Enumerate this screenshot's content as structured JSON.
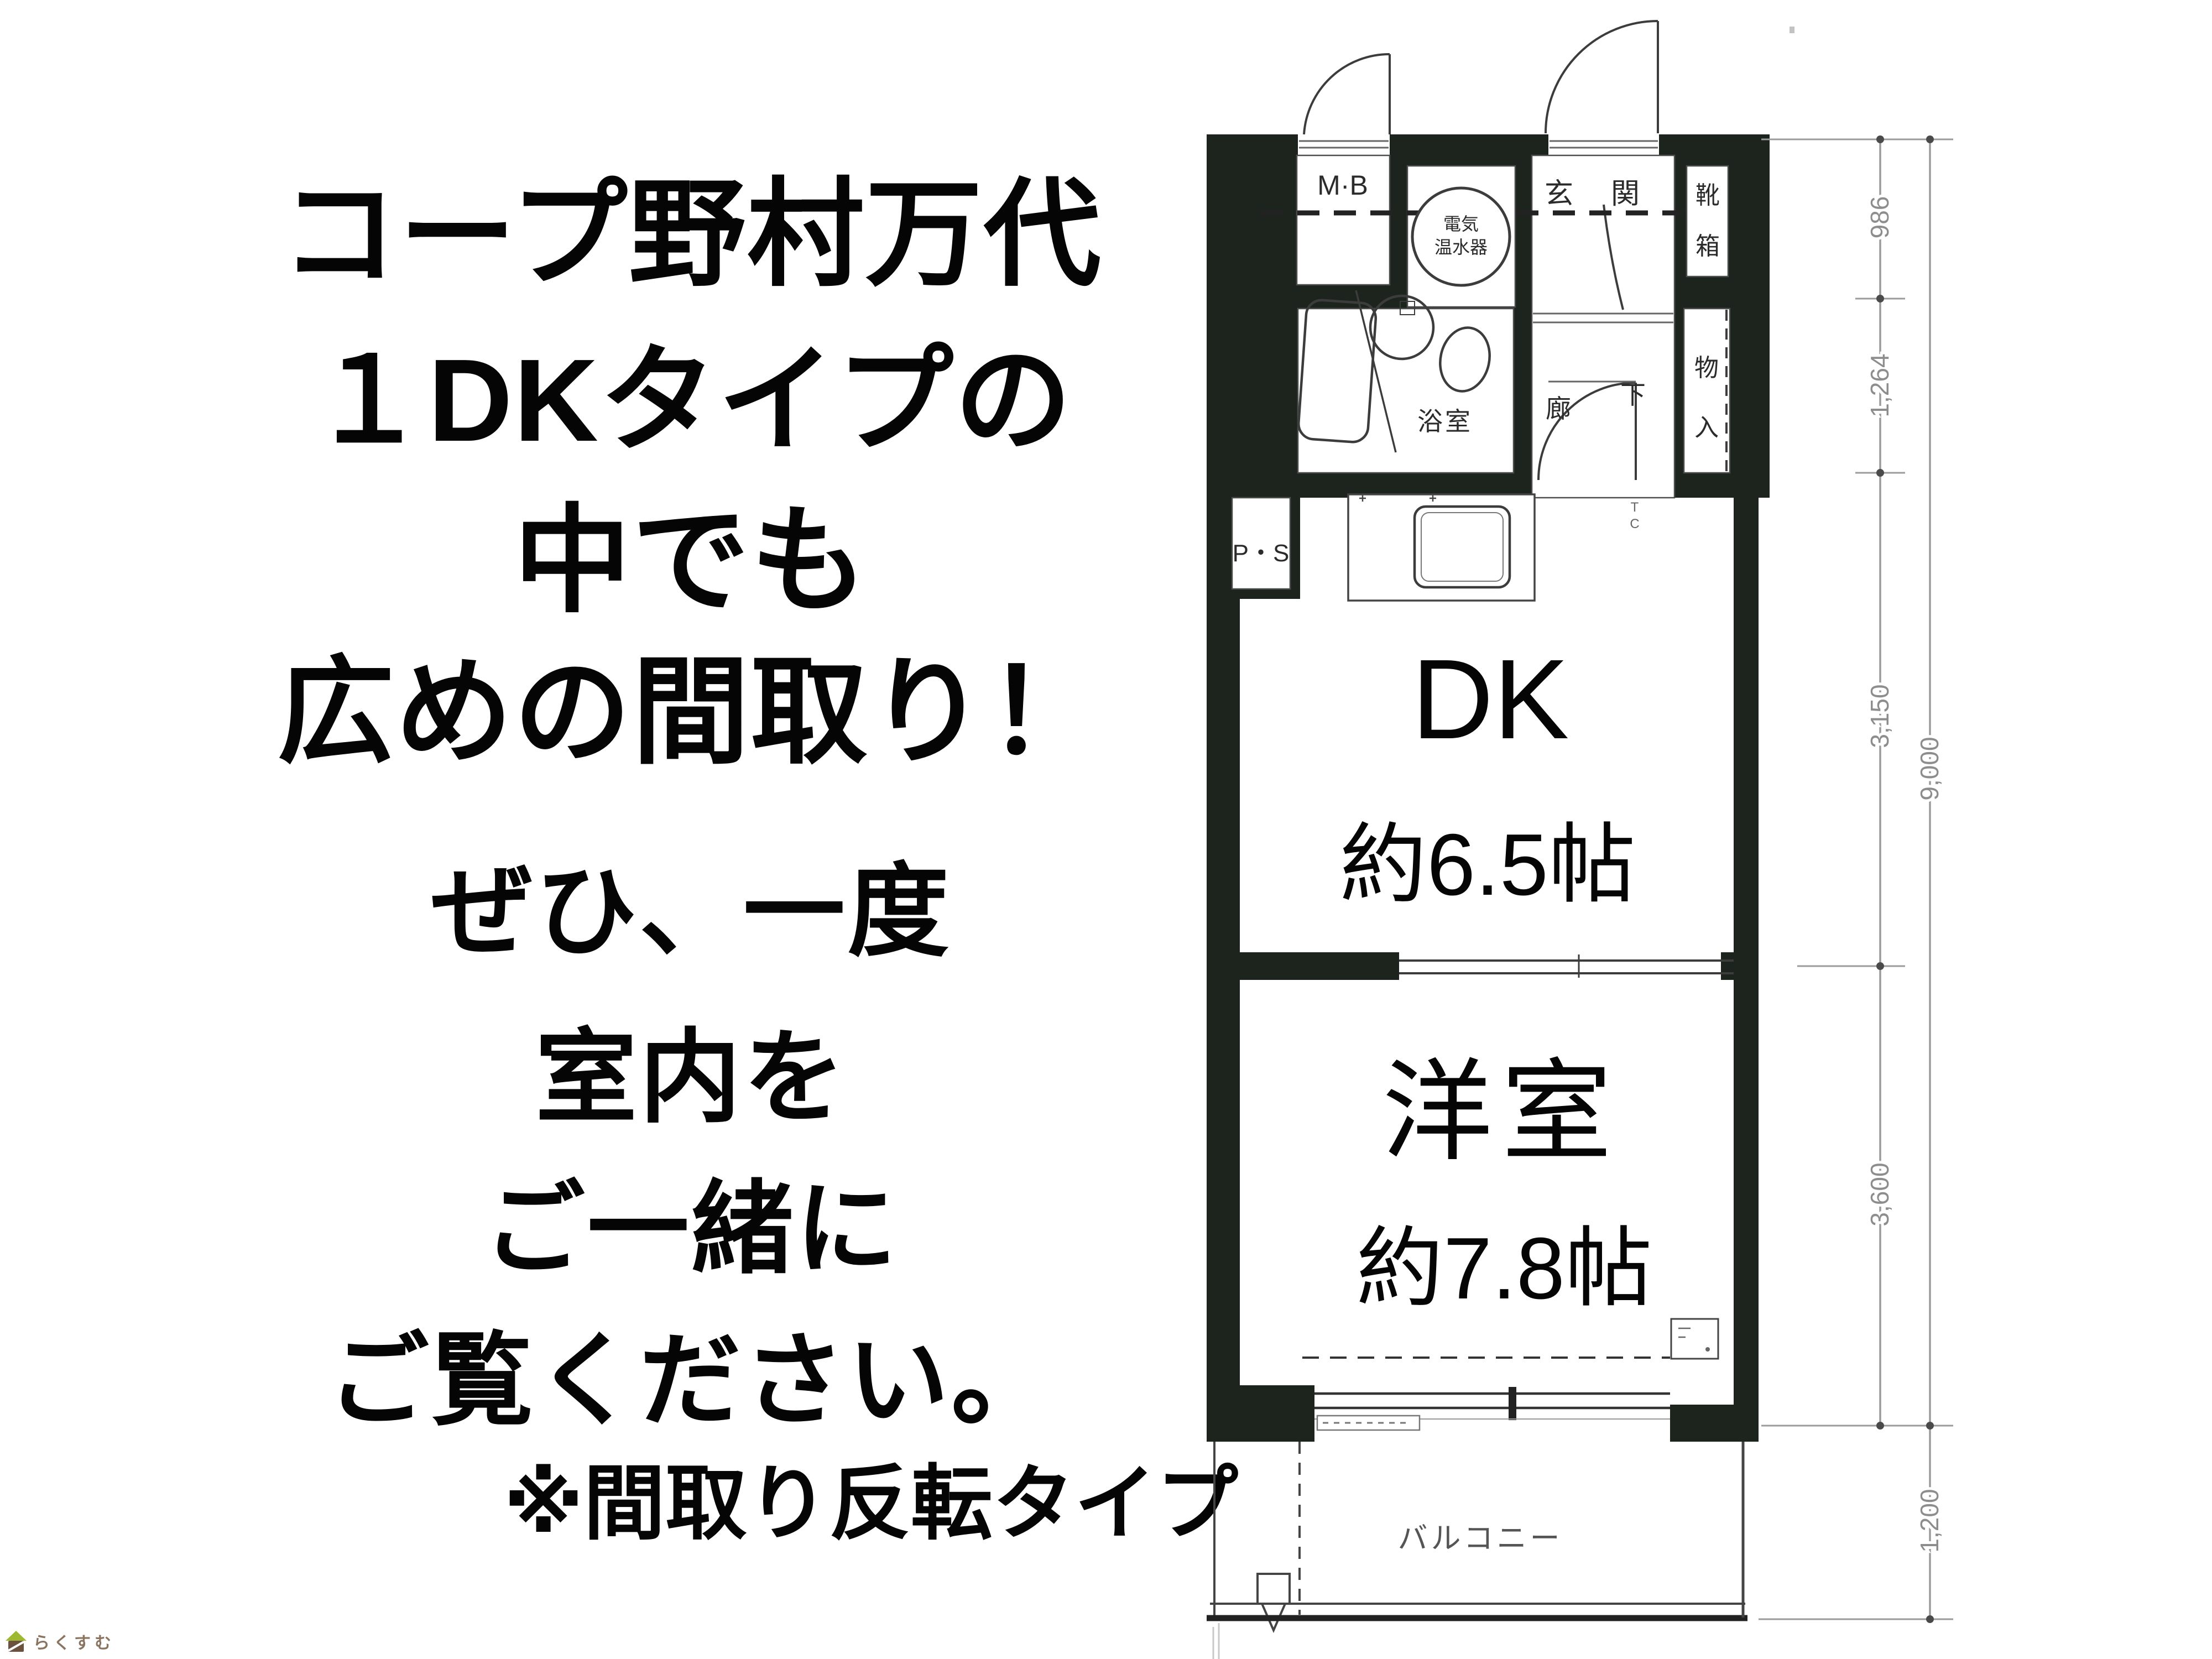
{
  "left_panel": {
    "headline": [
      "コープ野村万代",
      "１DKタイプの",
      "中でも",
      "広めの間取り！"
    ],
    "message": [
      "ぜひ、一度",
      "室内を",
      "ご一緒に",
      "ご覧ください。"
    ],
    "note": "※間取り反転タイプ"
  },
  "floor_plan": {
    "meter_box": "M·B",
    "water_heater_line1": "電気",
    "water_heater_line2": "温水器",
    "entrance": "玄　関",
    "shoe_cabinet_line1": "靴",
    "shoe_cabinet_line2": "箱",
    "bathroom": "浴室",
    "corridor_line1": "廊",
    "corridor_line2": "下",
    "storage_line1": "物",
    "storage_line2": "入",
    "toilet_cabinet_line1": "T",
    "toilet_cabinet_line2": "C",
    "pipe_space": "P・S",
    "dk_label": "DK",
    "dk_size": "約6.5帖",
    "western_room_label": "洋室",
    "western_room_size": "約7.8帖",
    "balcony": "バルコニー",
    "dimensions": {
      "top_section": "986",
      "second_section": "1,264",
      "dk_section": "3,150",
      "western_section": "3,600",
      "total": "9,000",
      "balcony_depth": "1,200"
    }
  },
  "logo": {
    "text": "らくすむ"
  }
}
